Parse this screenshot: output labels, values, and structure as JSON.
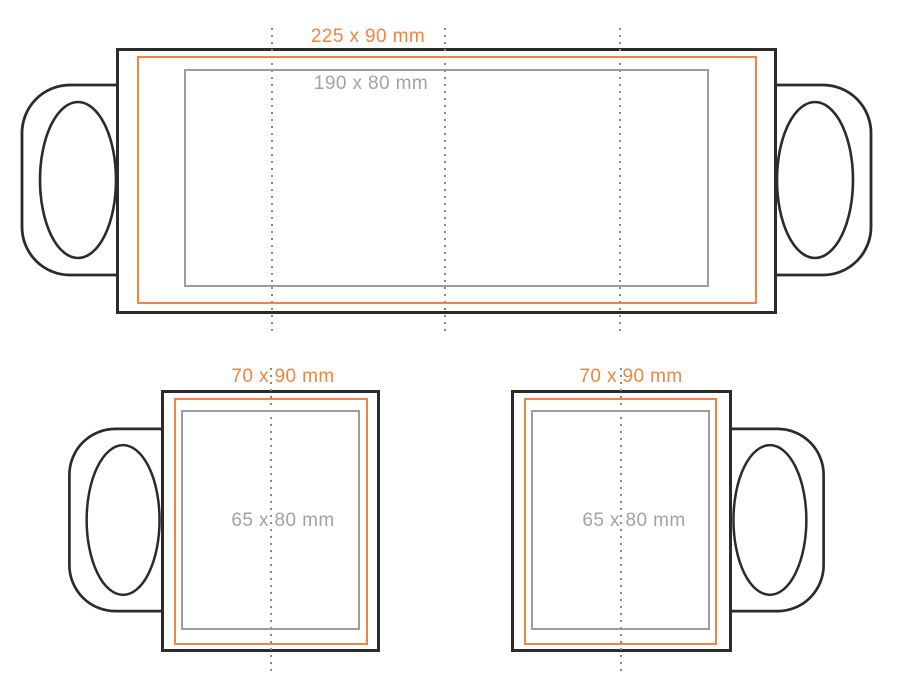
{
  "colors": {
    "mug_outline": "#2b2b2b",
    "print_area": "#ee8540",
    "safe_area": "#9d9d9d",
    "safe_text": "#a3a3a3",
    "guide_dots": "#8a8a8a",
    "background": "#ffffff"
  },
  "views": {
    "wrap": {
      "print_area_label": "225 x 90 mm",
      "safe_area_label": "190 x 80 mm"
    },
    "mug_left_handle": {
      "print_area_label": "70 x 90 mm",
      "safe_area_label": "65 x 80 mm"
    },
    "mug_right_handle": {
      "print_area_label": "70 x 90 mm",
      "safe_area_label": "65 x 80 mm"
    }
  }
}
